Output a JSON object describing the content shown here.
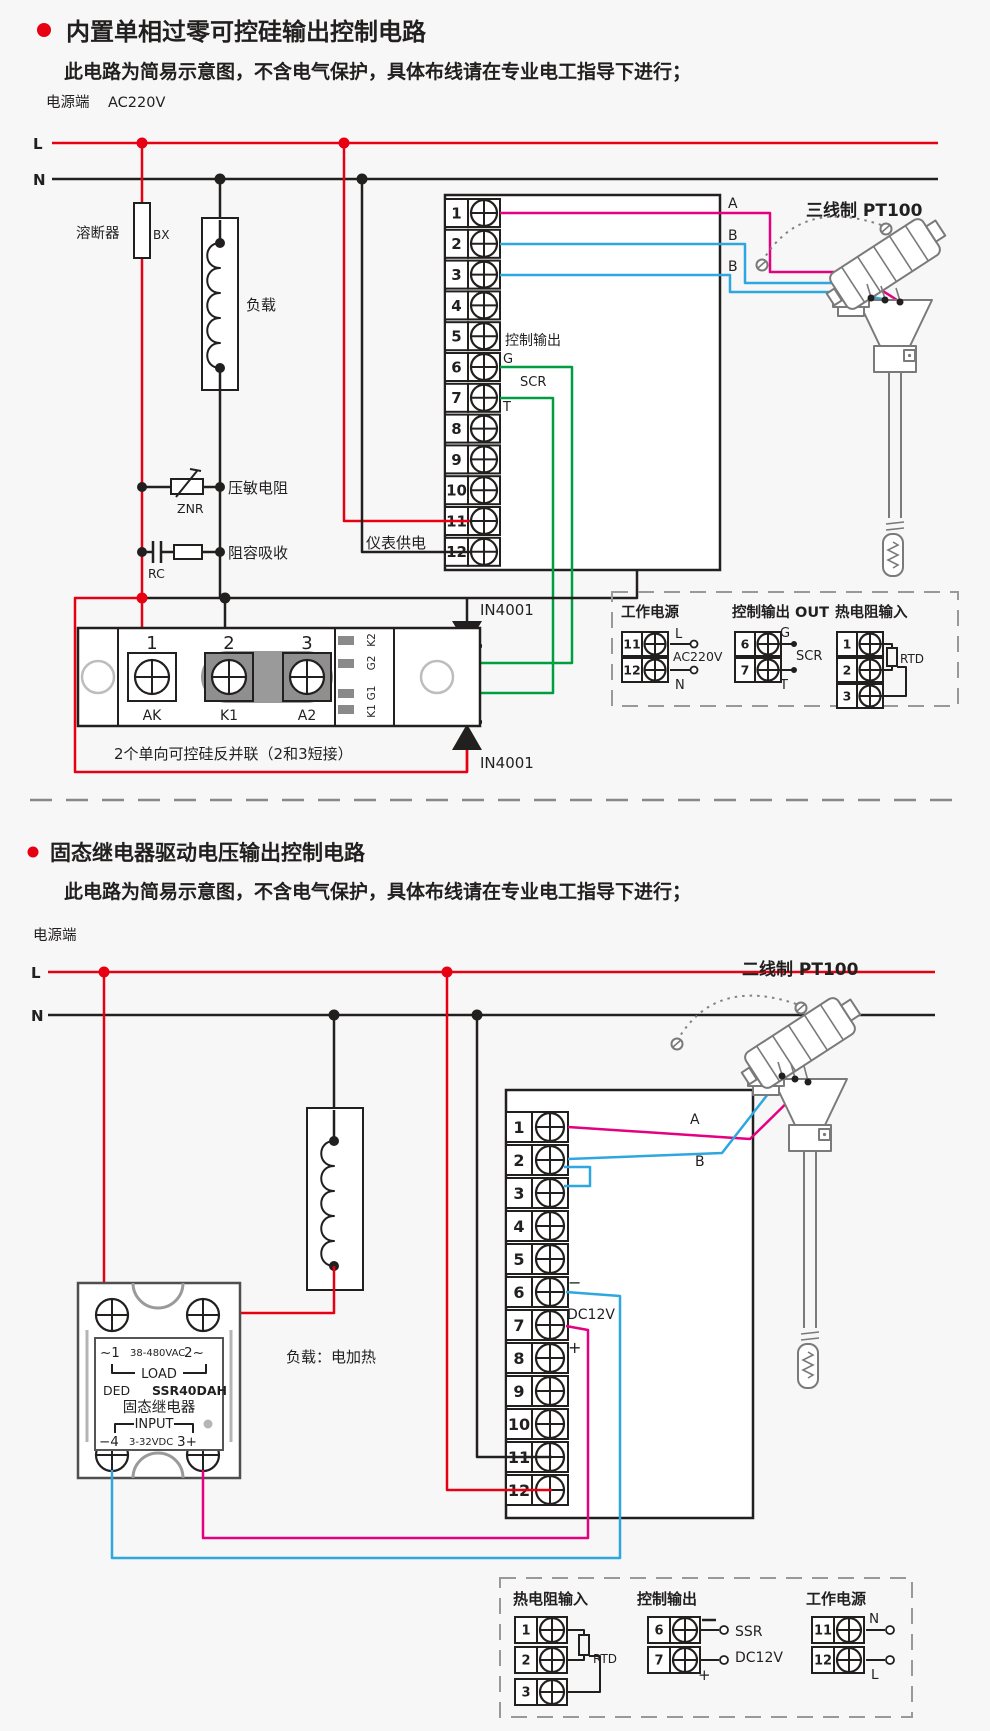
{
  "colors": {
    "accent_red": "#e60012",
    "ink": "#221f1f",
    "wire_magenta": "#e4007f",
    "wire_blue": "#2ea7e0",
    "wire_green": "#009e41",
    "module_gray": "#9a9a9a",
    "background": "#f7f7f7"
  },
  "section1": {
    "title": "内置单相过零可控硅输出控制电路",
    "subtitle": "此电路为简易示意图，不含电气保护，具体布线请在专业电工指导下进行；",
    "power_terminal": "电源端",
    "voltage": "AC220V",
    "live": "L",
    "neutral": "N",
    "fuse": "溶断器",
    "fuse_code": "BX",
    "load": "负载",
    "varistor": "压敏电阻",
    "varistor_code": "ZNR",
    "rc": "阻容吸收",
    "rc_code": "RC",
    "meter_supply": "仪表供电",
    "control_output": "控制输出",
    "gate": "G",
    "scr": "SCR",
    "t": "T",
    "diode": "IN4001",
    "terminals": [
      "1",
      "2",
      "3",
      "4",
      "5",
      "6",
      "7",
      "8",
      "9",
      "10",
      "11",
      "12"
    ],
    "wire_a": "A",
    "wire_b1": "B",
    "wire_b2": "B",
    "sensor": "三线制 PT100",
    "module": {
      "pin1": "1",
      "pin2": "2",
      "pin3": "3",
      "pin1_name": "AK",
      "pin2_name": "K1",
      "pin3_name": "A2",
      "side": [
        "K2",
        "G2",
        "G1",
        "K1"
      ],
      "caption": "2个单向可控硅反并联（2和3短接）"
    },
    "legend": {
      "power": {
        "title": "工作电源",
        "t1": "11",
        "t2": "12",
        "l": "L",
        "n": "N",
        "voltage": "AC220V"
      },
      "output": {
        "title": "控制输出 OUT",
        "t1": "6",
        "t2": "7",
        "g": "G",
        "scr": "SCR",
        "t": "T"
      },
      "rtd": {
        "title": "热电阻输入",
        "t1": "1",
        "t2": "2",
        "t3": "3",
        "label": "RTD"
      }
    }
  },
  "section2": {
    "title": "固态继电器驱动电压输出控制电路",
    "subtitle": "此电路为简易示意图，不含电气保护，具体布线请在专业电工指导下进行；",
    "power_terminal": "电源端",
    "live": "L",
    "neutral": "N",
    "load": "负载：电加热",
    "minus": "−",
    "plus": "+",
    "dc12v": "DC12V",
    "terminals": [
      "1",
      "2",
      "3",
      "4",
      "5",
      "6",
      "7",
      "8",
      "9",
      "10",
      "11",
      "12"
    ],
    "wire_a": "A",
    "wire_b": "B",
    "sensor": "二线制 PT100",
    "ssr": {
      "t1": "~1",
      "vac": "38-480VAC",
      "t2": "2~",
      "load": "LOAD",
      "ded": "DED",
      "model": "SSR40DAH",
      "name": "固态继电器",
      "input": "INPUT",
      "m4": "−4",
      "vdc": "3-32VDC",
      "p3": "3+"
    },
    "legend": {
      "rtd": {
        "title": "热电阻输入",
        "t1": "1",
        "t2": "2",
        "t3": "3",
        "label": "RTD"
      },
      "output": {
        "title": "控制输出",
        "t1": "6",
        "t2": "7",
        "ssr": "SSR",
        "dc": "DC12V",
        "minus": "−",
        "plus": "+"
      },
      "power": {
        "title": "工作电源",
        "t1": "11",
        "t2": "12",
        "n": "N",
        "l": "L"
      }
    }
  }
}
